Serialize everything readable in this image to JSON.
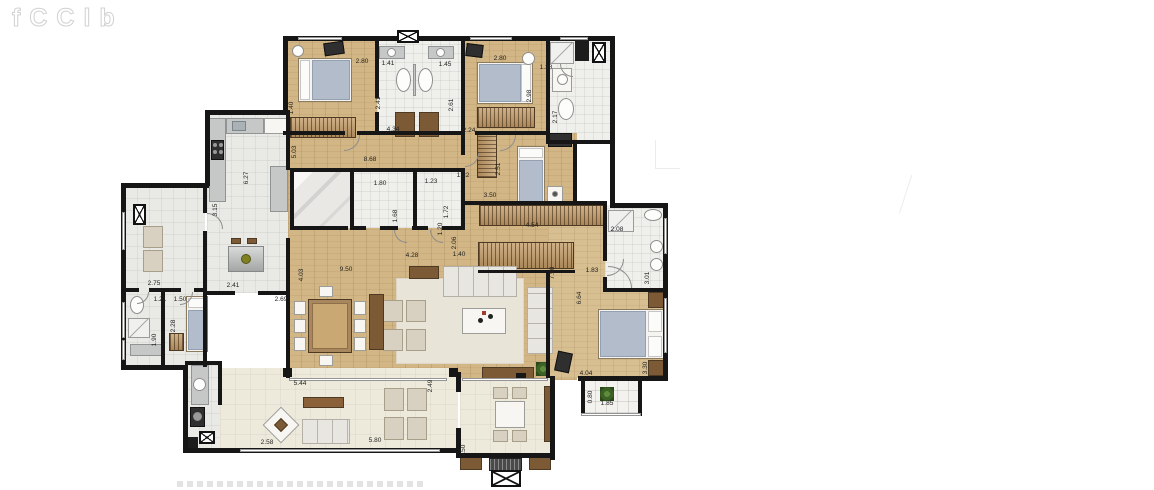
{
  "watermark": {
    "letters": [
      "f",
      "C",
      "C",
      "l",
      "b"
    ]
  },
  "colors": {
    "wall": "#161616",
    "wood_floor": "#d2b685",
    "suite_wood_floor": "#d8bf92",
    "tile_floor": "#efefec",
    "service_tile": "#e9e9e6",
    "terrace_floor": "#edeadc",
    "rug": "#e9e4d8",
    "wardrobe": "#c19a66",
    "furniture_brown": "#7c5a36",
    "mattress_blue": "#b2bcca",
    "plant_green": "#3c6325"
  },
  "dimensions": [
    {
      "text": "2.80",
      "x": 362,
      "y": 62,
      "v": false
    },
    {
      "text": "1.41",
      "x": 388,
      "y": 64,
      "v": false
    },
    {
      "text": "1.45",
      "x": 445,
      "y": 65,
      "v": false
    },
    {
      "text": "2.80",
      "x": 500,
      "y": 59,
      "v": false
    },
    {
      "text": "1.38",
      "x": 546,
      "y": 68,
      "v": false
    },
    {
      "text": "2.41",
      "x": 379,
      "y": 103,
      "v": true
    },
    {
      "text": "2.61",
      "x": 452,
      "y": 105,
      "v": true
    },
    {
      "text": "1.40",
      "x": 292,
      "y": 108,
      "v": true
    },
    {
      "text": "5.03",
      "x": 295,
      "y": 152,
      "v": true
    },
    {
      "text": "4.34",
      "x": 393,
      "y": 130,
      "v": false
    },
    {
      "text": "2.24",
      "x": 469,
      "y": 131,
      "v": false
    },
    {
      "text": "8.68",
      "x": 370,
      "y": 160,
      "v": false
    },
    {
      "text": "2.98",
      "x": 530,
      "y": 96,
      "v": true
    },
    {
      "text": "2.17",
      "x": 556,
      "y": 117,
      "v": true
    },
    {
      "text": "6.27",
      "x": 247,
      "y": 178,
      "v": true
    },
    {
      "text": "3.15",
      "x": 216,
      "y": 210,
      "v": true
    },
    {
      "text": "1.22",
      "x": 463,
      "y": 176,
      "v": false
    },
    {
      "text": "1.80",
      "x": 380,
      "y": 184,
      "v": false
    },
    {
      "text": "1.23",
      "x": 431,
      "y": 182,
      "v": false
    },
    {
      "text": "1.68",
      "x": 396,
      "y": 216,
      "v": true
    },
    {
      "text": "1.72",
      "x": 447,
      "y": 212,
      "v": true
    },
    {
      "text": "1.20",
      "x": 441,
      "y": 229,
      "v": true
    },
    {
      "text": "2.06",
      "x": 455,
      "y": 243,
      "v": true
    },
    {
      "text": "2.51",
      "x": 499,
      "y": 169,
      "v": true
    },
    {
      "text": "3.50",
      "x": 490,
      "y": 196,
      "v": false
    },
    {
      "text": "4.54",
      "x": 532,
      "y": 226,
      "v": false
    },
    {
      "text": "2.08",
      "x": 617,
      "y": 230,
      "v": false
    },
    {
      "text": "1.83",
      "x": 592,
      "y": 271,
      "v": false
    },
    {
      "text": "3.01",
      "x": 648,
      "y": 278,
      "v": true
    },
    {
      "text": "6.64",
      "x": 580,
      "y": 298,
      "v": true
    },
    {
      "text": "7.50",
      "x": 553,
      "y": 273,
      "v": true
    },
    {
      "text": "4.04",
      "x": 586,
      "y": 374,
      "v": false
    },
    {
      "text": "3.30",
      "x": 646,
      "y": 368,
      "v": true
    },
    {
      "text": "0.80",
      "x": 591,
      "y": 397,
      "v": true
    },
    {
      "text": "1.85",
      "x": 607,
      "y": 404,
      "v": false
    },
    {
      "text": "9.50",
      "x": 346,
      "y": 270,
      "v": false
    },
    {
      "text": "4.03",
      "x": 302,
      "y": 275,
      "v": true
    },
    {
      "text": "2.69",
      "x": 281,
      "y": 300,
      "v": false
    },
    {
      "text": "4.28",
      "x": 412,
      "y": 256,
      "v": false
    },
    {
      "text": "1.40",
      "x": 459,
      "y": 255,
      "v": false
    },
    {
      "text": "2.41",
      "x": 233,
      "y": 286,
      "v": false
    },
    {
      "text": "2.75",
      "x": 154,
      "y": 284,
      "v": false
    },
    {
      "text": "1.21",
      "x": 160,
      "y": 300,
      "v": false
    },
    {
      "text": "1.50",
      "x": 180,
      "y": 300,
      "v": false
    },
    {
      "text": "2.28",
      "x": 174,
      "y": 326,
      "v": true
    },
    {
      "text": "1.90",
      "x": 155,
      "y": 340,
      "v": true
    },
    {
      "text": "5.44",
      "x": 300,
      "y": 384,
      "v": false
    },
    {
      "text": "5.80",
      "x": 375,
      "y": 441,
      "v": false
    },
    {
      "text": "2.49",
      "x": 431,
      "y": 386,
      "v": true
    },
    {
      "text": "3.50",
      "x": 464,
      "y": 451,
      "v": true
    },
    {
      "text": "2.58",
      "x": 267,
      "y": 443,
      "v": false
    }
  ]
}
